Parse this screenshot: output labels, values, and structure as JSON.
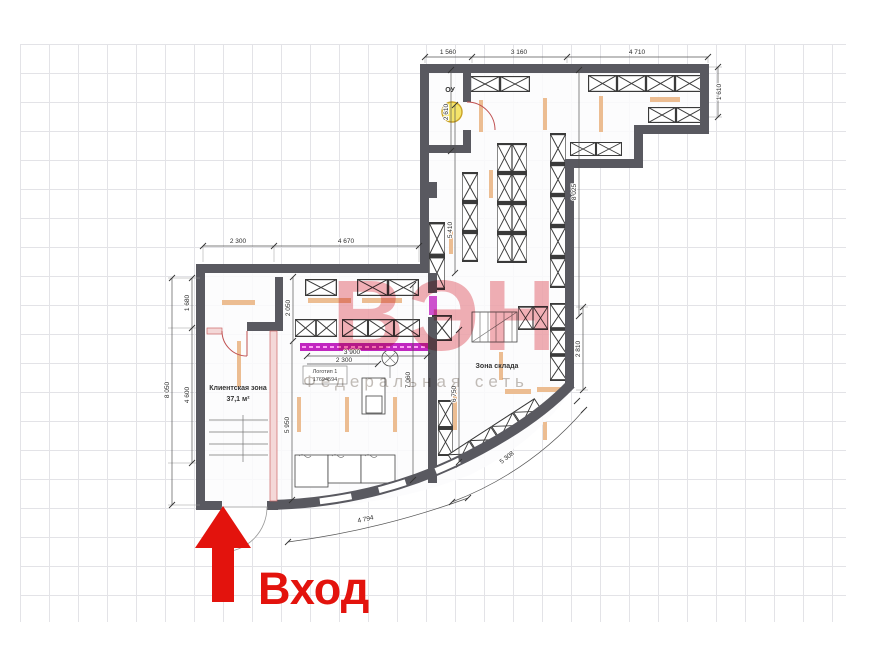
{
  "colors": {
    "wall": "#595960",
    "accent_red": "#e3130d",
    "magenta_sign": "#c026c0",
    "orange_fixture": "#ecbd92",
    "watermark_pink": "#e4606b",
    "watermark_gray": "#b9b2ac",
    "lamp_yellow": "#f4e46a"
  },
  "watermark": {
    "brand": "ВЭН",
    "subtitle": "Федеральная сеть"
  },
  "entrance": {
    "label": "Вход"
  },
  "rooms": {
    "client_zone": {
      "name": "Клиентская зона",
      "area": "37,1 м²"
    },
    "warehouse": {
      "name": "Зона склада"
    },
    "lighting_unit": {
      "name": "ОУ"
    }
  },
  "sign": {
    "label": "Логотип 1",
    "code": "17694594"
  },
  "dims": {
    "t1": "1 560",
    "t2": "3 160",
    "t3": "4 710",
    "r1": "1 610",
    "r2": "8 025",
    "r3": "2 810",
    "w1": "5 410",
    "w2": "2 610",
    "w3": "6 750",
    "lt1": "2 300",
    "lt2": "4 670",
    "ll1": "1 680",
    "ll2": "4 600",
    "ll3": "8 050",
    "s1": "2 050",
    "s2": "5 950",
    "s3": "7 060",
    "g1": "3 900",
    "g2": "2 300",
    "a1": "4 794",
    "a2": "5 308"
  }
}
